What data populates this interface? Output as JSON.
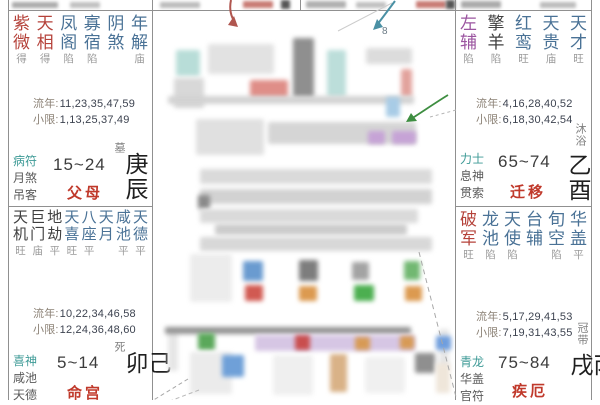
{
  "palaces": [
    {
      "name": "父母",
      "stars": [
        {
          "c": "紫微",
          "b": "得",
          "t": "main"
        },
        {
          "c": "天相",
          "b": "得",
          "t": "main"
        },
        {
          "c": "凤阁",
          "b": "陷",
          "t": "lucky"
        },
        {
          "c": "寡宿",
          "b": "陷",
          "t": "lucky"
        },
        {
          "c": "阴煞",
          "b": "",
          "t": "lucky"
        },
        {
          "c": "年解",
          "b": "庙",
          "t": "lucky"
        }
      ],
      "liunian_label": "流年:",
      "liunian_values": "11,23,35,47,59",
      "xiaoxian_label": "小限:",
      "xiaoxian_values": "1,13,25,37,49",
      "gods": [
        "病符",
        "月煞",
        "吊客"
      ],
      "age_range": "15~24",
      "stem_branch": "庚辰",
      "stage": "墓"
    },
    {
      "name": "命宫",
      "stars": [
        {
          "c": "天机",
          "b": "旺",
          "t": "dark"
        },
        {
          "c": "巨门",
          "b": "庙",
          "t": "dark"
        },
        {
          "c": "地劫",
          "b": "平",
          "t": "dark"
        },
        {
          "c": "天喜",
          "b": "旺",
          "t": "lucky"
        },
        {
          "c": "八座",
          "b": "平",
          "t": "lucky"
        },
        {
          "c": "天月",
          "b": "",
          "t": "lucky"
        },
        {
          "c": "咸池",
          "b": "平",
          "t": "lucky"
        },
        {
          "c": "天德",
          "b": "平",
          "t": "lucky"
        }
      ],
      "liunian_label": "流年:",
      "liunian_values": "10,22,34,46,58",
      "xiaoxian_label": "小限:",
      "xiaoxian_values": "12,24,36,48,60",
      "gods": [
        "喜神",
        "咸池",
        "天德"
      ],
      "age_range": "5~14",
      "stem_branch": "己卯",
      "stage": "死"
    },
    {
      "name": "迁移",
      "stars": [
        {
          "c": "左辅",
          "b": "陷",
          "t": "purple"
        },
        {
          "c": "擎羊",
          "b": "陷",
          "t": "dark"
        },
        {
          "c": "红鸾",
          "b": "旺",
          "t": "lucky"
        },
        {
          "c": "天贵",
          "b": "庙",
          "t": "lucky"
        },
        {
          "c": "天才",
          "b": "旺",
          "t": "lucky"
        }
      ],
      "liunian_label": "流年:",
      "liunian_values": "4,16,28,40,52",
      "xiaoxian_label": "小限:",
      "xiaoxian_values": "6,18,30,42,54",
      "gods": [
        "力士",
        "息神",
        "贯索"
      ],
      "age_range": "65~74",
      "stem_branch": "乙酉",
      "stage": "沐浴"
    },
    {
      "name": "疾厄",
      "stars": [
        {
          "c": "破军",
          "b": "旺",
          "t": "main"
        },
        {
          "c": "龙池",
          "b": "陷",
          "t": "lucky"
        },
        {
          "c": "天使",
          "b": "陷",
          "t": "lucky"
        },
        {
          "c": "台辅",
          "b": "",
          "t": "lucky"
        },
        {
          "c": "旬空",
          "b": "陷",
          "t": "lucky"
        },
        {
          "c": "华盖",
          "b": "平",
          "t": "lucky"
        }
      ],
      "liunian_label": "流年:",
      "liunian_values": "5,17,29,41,53",
      "xiaoxian_label": "小限:",
      "xiaoxian_values": "7,19,31,43,55",
      "gods": [
        "青龙",
        "华盖",
        "官符"
      ],
      "age_range": "75~84",
      "stem_branch": "丙戌",
      "stage": "冠带"
    }
  ],
  "annotations": {
    "small_digit": "8"
  },
  "colors": {
    "main_star": "#b5423a",
    "dark_star": "#3f3f3f",
    "lucky_star": "#4a7296",
    "purple_star": "#9b55a0",
    "god_first": "#3d9a96",
    "god_rest": "#5a5a5a",
    "palace_name": "#c0392b",
    "brightness": "#9a9a9a",
    "border": "#909090",
    "red_arrow": "#b0564f",
    "blue_arrow": "#4a90a4",
    "green_arrow": "#3e8e41"
  }
}
